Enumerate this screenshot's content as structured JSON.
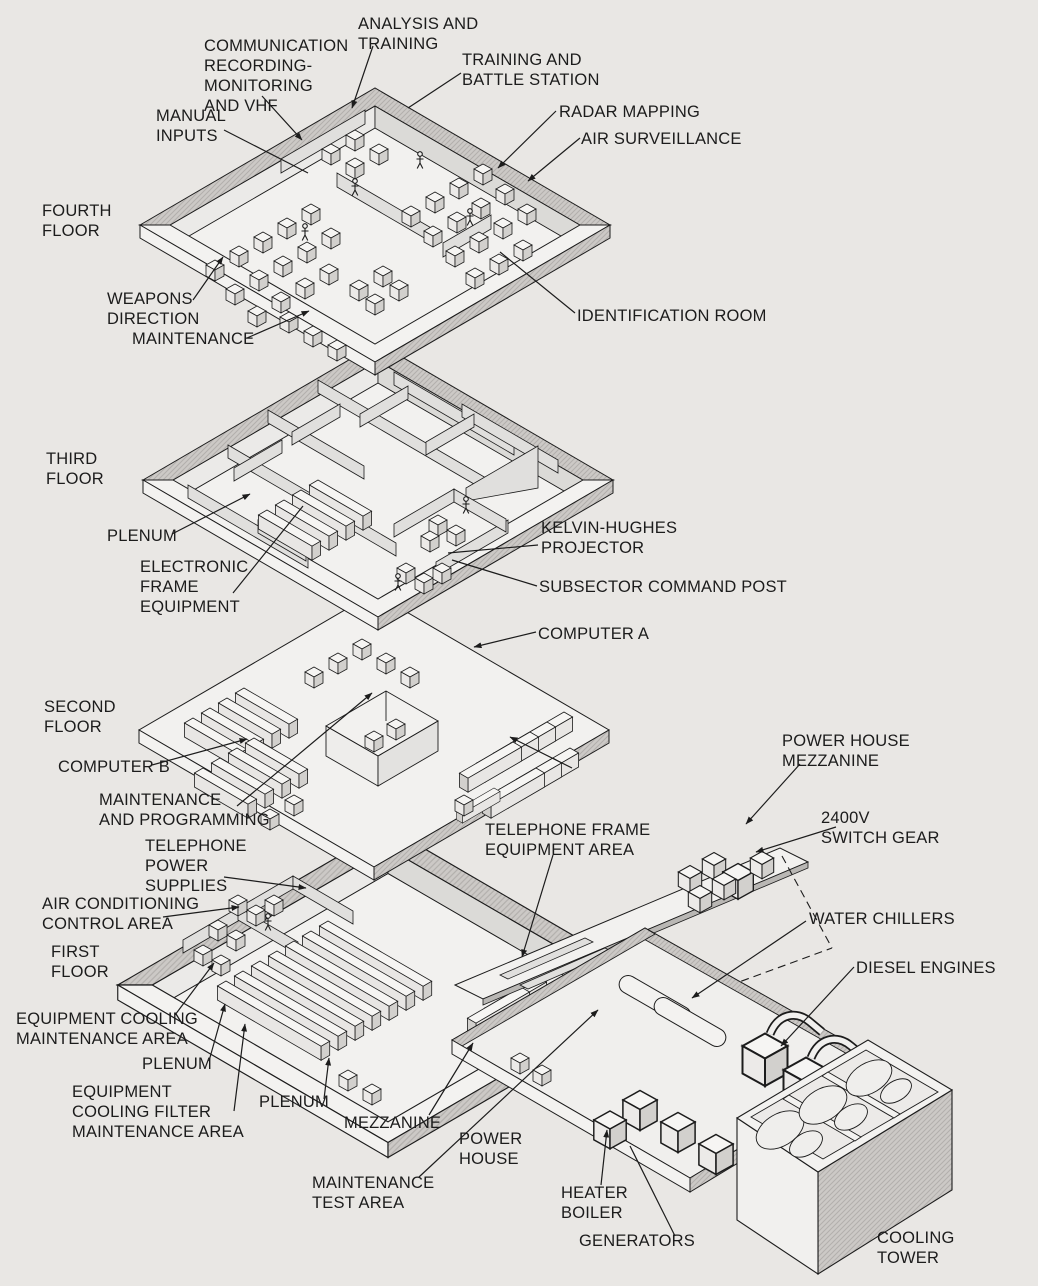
{
  "figure": {
    "type": "exploded-isometric-building-diagram",
    "colors": {
      "background": "#e9e7e4",
      "ink": "#1c1c1c",
      "wall_shade": "#cbc9c6",
      "face_light": "#f3f2f0",
      "face_mid": "#dbdad7"
    }
  },
  "labels": [
    {
      "id": "analysis-and-training",
      "text": "ANALYSIS AND\nTRAINING"
    },
    {
      "id": "communication-recording",
      "text": "COMMUNICATION\nRECORDING-\nMONITORING\nAND VHF"
    },
    {
      "id": "training-and-battle-station",
      "text": "TRAINING AND\nBATTLE STATION"
    },
    {
      "id": "manual-inputs",
      "text": "MANUAL\nINPUTS"
    },
    {
      "id": "radar-mapping",
      "text": "RADAR MAPPING"
    },
    {
      "id": "air-surveillance",
      "text": "AIR SURVEILLANCE"
    },
    {
      "id": "fourth-floor",
      "text": "FOURTH\nFLOOR"
    },
    {
      "id": "weapons-direction",
      "text": "WEAPONS\nDIRECTION"
    },
    {
      "id": "maintenance",
      "text": "MAINTENANCE"
    },
    {
      "id": "identification-room",
      "text": "IDENTIFICATION ROOM"
    },
    {
      "id": "third-floor",
      "text": "THIRD\nFLOOR"
    },
    {
      "id": "plenum-third",
      "text": "PLENUM"
    },
    {
      "id": "electronic-frame-equipment",
      "text": "ELECTRONIC\nFRAME\nEQUIPMENT"
    },
    {
      "id": "kelvin-hughes-projector",
      "text": "KELVIN-HUGHES\nPROJECTOR"
    },
    {
      "id": "subsector-command-post",
      "text": "SUBSECTOR COMMAND POST"
    },
    {
      "id": "computer-a",
      "text": "COMPUTER A"
    },
    {
      "id": "second-floor",
      "text": "SECOND\nFLOOR"
    },
    {
      "id": "computer-b",
      "text": "COMPUTER B"
    },
    {
      "id": "maintenance-and-programming",
      "text": "MAINTENANCE\nAND PROGRAMMING"
    },
    {
      "id": "power-house-mezzanine",
      "text": "POWER HOUSE\nMEZZANINE"
    },
    {
      "id": "switch-gear-2400v",
      "text": "2400V\nSWITCH GEAR"
    },
    {
      "id": "telephone-frame-equipment-area",
      "text": "TELEPHONE FRAME\nEQUIPMENT AREA"
    },
    {
      "id": "telephone-power-supplies",
      "text": "TELEPHONE\nPOWER\nSUPPLIES"
    },
    {
      "id": "air-conditioning-control-area",
      "text": "AIR CONDITIONING\nCONTROL AREA"
    },
    {
      "id": "first-floor",
      "text": "FIRST\nFLOOR"
    },
    {
      "id": "equipment-cooling-maintenance",
      "text": "EQUIPMENT COOLING\nMAINTENANCE AREA"
    },
    {
      "id": "plenum-first-a",
      "text": "PLENUM"
    },
    {
      "id": "equipment-cooling-filter",
      "text": "EQUIPMENT\nCOOLING FILTER\nMAINTENANCE AREA"
    },
    {
      "id": "plenum-first-b",
      "text": "PLENUM"
    },
    {
      "id": "mezzanine",
      "text": "MEZZANINE"
    },
    {
      "id": "power-house",
      "text": "POWER\nHOUSE"
    },
    {
      "id": "maintenance-test-area",
      "text": "MAINTENANCE\nTEST AREA"
    },
    {
      "id": "water-chillers",
      "text": "WATER CHILLERS"
    },
    {
      "id": "diesel-engines",
      "text": "DIESEL ENGINES"
    },
    {
      "id": "heater-boiler",
      "text": "HEATER\nBOILER"
    },
    {
      "id": "generators",
      "text": "GENERATORS"
    },
    {
      "id": "cooling-tower",
      "text": "COOLING\nTOWER"
    }
  ]
}
